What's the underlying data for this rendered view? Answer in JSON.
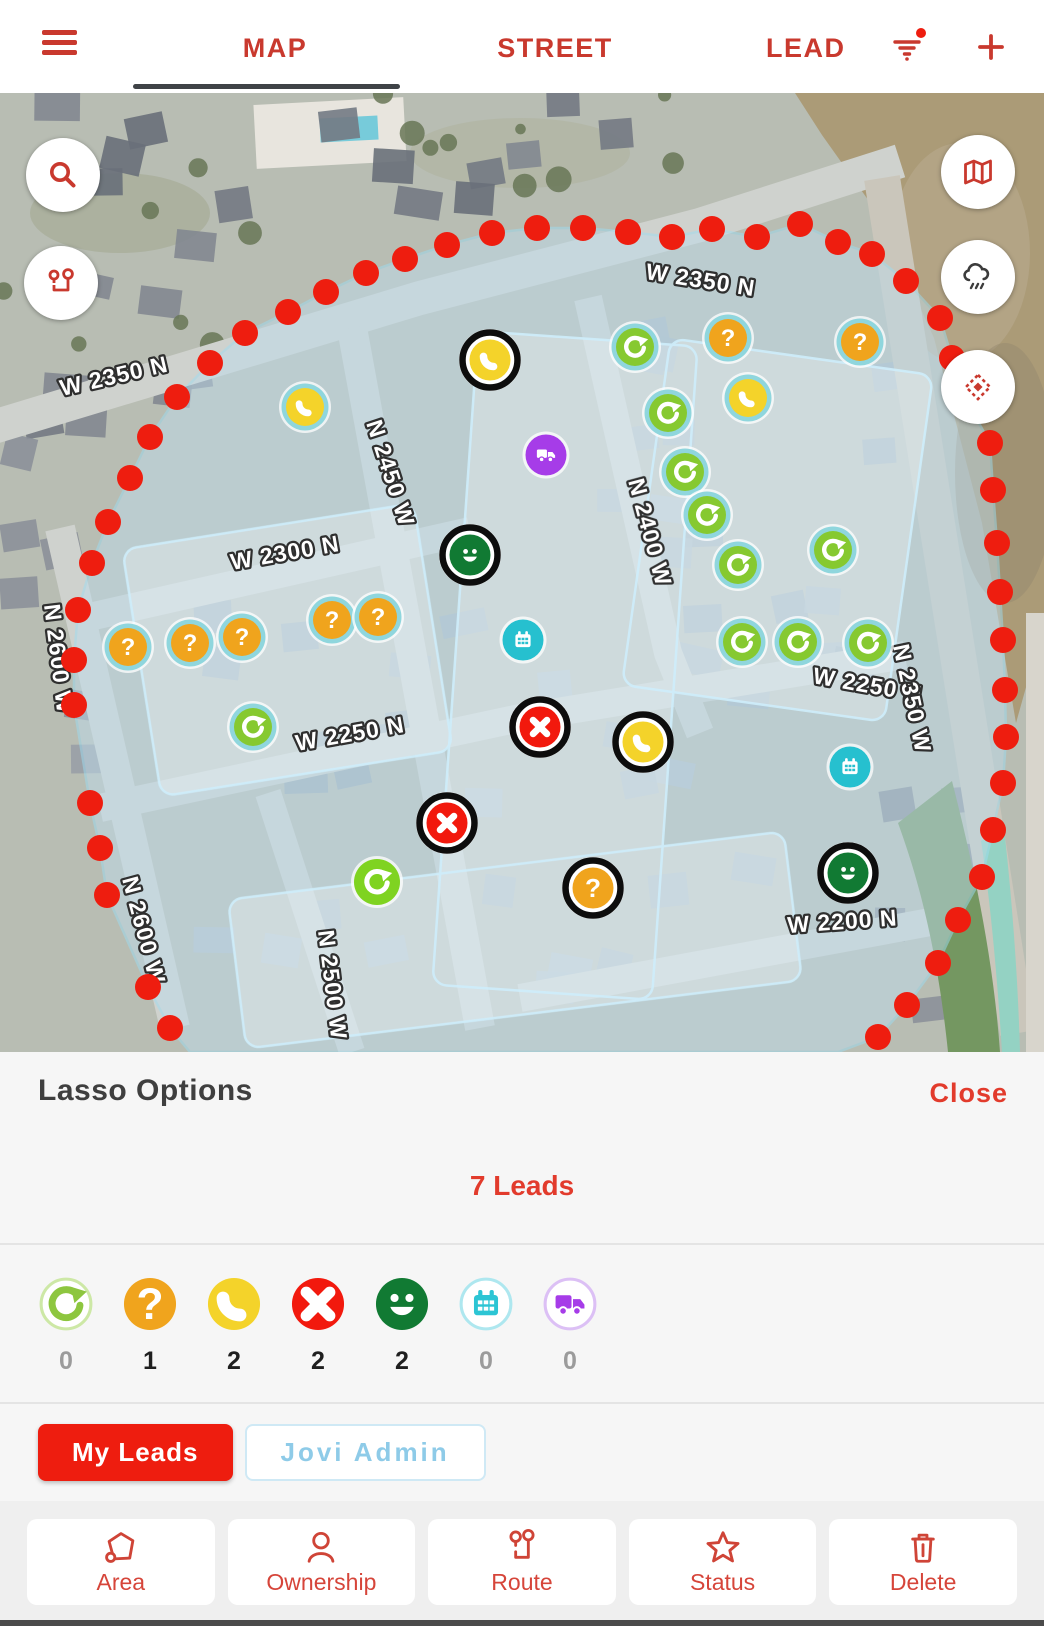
{
  "app": {
    "accent": "#c9392e",
    "bright_red": "#ee1d0f"
  },
  "top_bar": {
    "menu_icon": "hamburger-icon",
    "tabs": [
      {
        "label": "MAP",
        "active": true
      },
      {
        "label": "STREET",
        "active": false
      },
      {
        "label": "LEAD",
        "active": false
      }
    ],
    "filter_icon": "filter-icon",
    "filter_badge_color": "#ee1d0f",
    "add_icon": "plus-icon"
  },
  "map": {
    "controls_left": [
      {
        "icon": "search-icon"
      },
      {
        "icon": "route-pins-icon"
      }
    ],
    "controls_right": [
      {
        "icon": "map-layers-icon"
      },
      {
        "icon": "weather-icon"
      },
      {
        "icon": "lasso-target-icon"
      }
    ],
    "street_labels": [
      {
        "text": "W 2350 N",
        "x": 62,
        "y": 303,
        "rot": -13
      },
      {
        "text": "W 2350 N",
        "x": 645,
        "y": 186,
        "rot": 9
      },
      {
        "text": "N 2450 W",
        "x": 366,
        "y": 330,
        "rot": 72
      },
      {
        "text": "N 2400 W",
        "x": 628,
        "y": 388,
        "rot": 75
      },
      {
        "text": "W 2300 N",
        "x": 232,
        "y": 477,
        "rot": -10
      },
      {
        "text": "N 2600 W",
        "x": 44,
        "y": 512,
        "rot": 83
      },
      {
        "text": "W 2250 N",
        "x": 297,
        "y": 658,
        "rot": -10
      },
      {
        "text": "W 2250 N",
        "x": 812,
        "y": 590,
        "rot": 10
      },
      {
        "text": "N 2350 W",
        "x": 893,
        "y": 553,
        "rot": 78
      },
      {
        "text": "N 2600 W",
        "x": 122,
        "y": 786,
        "rot": 75
      },
      {
        "text": "N 2500 W",
        "x": 318,
        "y": 838,
        "rot": 83
      },
      {
        "text": "W 2200 N",
        "x": 788,
        "y": 840,
        "rot": -4
      }
    ],
    "lasso": {
      "dot_color": "#ee1d0f",
      "fill": "#bfdcec",
      "stroke": "#9edcf2",
      "dots": [
        [
          170,
          935
        ],
        [
          148,
          894
        ],
        [
          107,
          802
        ],
        [
          100,
          755
        ],
        [
          90,
          710
        ],
        [
          74,
          612
        ],
        [
          74,
          567
        ],
        [
          78,
          517
        ],
        [
          92,
          470
        ],
        [
          108,
          429
        ],
        [
          130,
          385
        ],
        [
          150,
          344
        ],
        [
          177,
          304
        ],
        [
          210,
          270
        ],
        [
          245,
          240
        ],
        [
          288,
          219
        ],
        [
          326,
          199
        ],
        [
          366,
          180
        ],
        [
          405,
          166
        ],
        [
          447,
          152
        ],
        [
          492,
          140
        ],
        [
          537,
          135
        ],
        [
          583,
          135
        ],
        [
          628,
          139
        ],
        [
          672,
          144
        ],
        [
          712,
          136
        ],
        [
          757,
          144
        ],
        [
          800,
          131
        ],
        [
          838,
          149
        ],
        [
          872,
          161
        ],
        [
          906,
          188
        ],
        [
          940,
          225
        ],
        [
          952,
          265
        ],
        [
          966,
          307
        ],
        [
          990,
          350
        ],
        [
          993,
          397
        ],
        [
          997,
          450
        ],
        [
          1000,
          499
        ],
        [
          1003,
          547
        ],
        [
          1005,
          597
        ],
        [
          1006,
          644
        ],
        [
          1003,
          690
        ],
        [
          993,
          737
        ],
        [
          982,
          784
        ],
        [
          958,
          827
        ],
        [
          938,
          870
        ],
        [
          907,
          912
        ],
        [
          878,
          944
        ]
      ]
    },
    "marker_colors": {
      "refresh": "#86c930",
      "refresh_bright": "#7fd321",
      "question": "#f0a41d",
      "phone": "#f4d32a",
      "x": "#f2190d",
      "smiley": "#117a33",
      "calendar": "#26c0cf",
      "truck": "#a63ce8"
    },
    "ring_colors": {
      "teal": "#8fd6dd",
      "selected": "#0d0d0d"
    },
    "markers": [
      {
        "type": "phone",
        "ring": "teal",
        "x": 305,
        "y": 314
      },
      {
        "type": "truck",
        "ring": "plain",
        "x": 546,
        "y": 362
      },
      {
        "type": "calendar",
        "ring": "plain",
        "x": 523,
        "y": 547
      },
      {
        "type": "calendar",
        "ring": "plain",
        "x": 850,
        "y": 674
      },
      {
        "type": "refresh",
        "ring": "teal",
        "x": 253,
        "y": 634
      },
      {
        "type": "refresh_bright",
        "ring": "plain",
        "x": 377,
        "y": 789
      },
      {
        "type": "question",
        "ring": "teal",
        "x": 128,
        "y": 554
      },
      {
        "type": "question",
        "ring": "teal",
        "x": 190,
        "y": 550
      },
      {
        "type": "question",
        "ring": "teal",
        "x": 242,
        "y": 544
      },
      {
        "type": "question",
        "ring": "teal",
        "x": 332,
        "y": 527
      },
      {
        "type": "question",
        "ring": "teal",
        "x": 378,
        "y": 524
      },
      {
        "type": "question",
        "ring": "teal",
        "x": 728,
        "y": 245
      },
      {
        "type": "question",
        "ring": "teal",
        "x": 860,
        "y": 249
      },
      {
        "type": "phone",
        "ring": "teal",
        "x": 748,
        "y": 305
      },
      {
        "type": "refresh",
        "ring": "teal",
        "x": 635,
        "y": 254
      },
      {
        "type": "refresh",
        "ring": "teal",
        "x": 668,
        "y": 320
      },
      {
        "type": "refresh",
        "ring": "teal",
        "x": 685,
        "y": 379
      },
      {
        "type": "refresh",
        "ring": "teal",
        "x": 707,
        "y": 422
      },
      {
        "type": "refresh",
        "ring": "teal",
        "x": 738,
        "y": 472
      },
      {
        "type": "refresh",
        "ring": "teal",
        "x": 833,
        "y": 457
      },
      {
        "type": "refresh",
        "ring": "teal",
        "x": 742,
        "y": 549
      },
      {
        "type": "refresh",
        "ring": "teal",
        "x": 798,
        "y": 549
      },
      {
        "type": "refresh",
        "ring": "teal",
        "x": 868,
        "y": 550
      },
      {
        "type": "phone",
        "ring": "selected",
        "x": 490,
        "y": 267
      },
      {
        "type": "smiley",
        "ring": "selected",
        "x": 470,
        "y": 462
      },
      {
        "type": "x",
        "ring": "selected",
        "x": 540,
        "y": 634
      },
      {
        "type": "phone",
        "ring": "selected",
        "x": 643,
        "y": 649
      },
      {
        "type": "x",
        "ring": "selected",
        "x": 447,
        "y": 730
      },
      {
        "type": "question",
        "ring": "selected",
        "x": 593,
        "y": 795
      },
      {
        "type": "smiley",
        "ring": "selected",
        "x": 848,
        "y": 780
      }
    ]
  },
  "lasso_panel": {
    "title": "Lasso Options",
    "close_label": "Close",
    "leads_summary": "7 Leads",
    "statuses": [
      {
        "type": "refresh",
        "count": 0,
        "color": "#8dc63f",
        "style": "outline",
        "border": "#cde8a6"
      },
      {
        "type": "question",
        "count": 1,
        "color": "#f0a41d",
        "style": "filled"
      },
      {
        "type": "phone",
        "count": 2,
        "color": "#f4d32a",
        "style": "filled"
      },
      {
        "type": "x",
        "count": 2,
        "color": "#f2190d",
        "style": "filled"
      },
      {
        "type": "smiley",
        "count": 2,
        "color": "#117a33",
        "style": "filled"
      },
      {
        "type": "calendar",
        "count": 0,
        "color": "#2cc5d4",
        "style": "outline",
        "border": "#aee7ef"
      },
      {
        "type": "truck",
        "count": 0,
        "color": "#a63ce8",
        "style": "outline",
        "border": "#dcc0f5"
      }
    ],
    "owner_filters": [
      {
        "label": "My Leads",
        "active": true
      },
      {
        "label": "Jovi Admin",
        "active": false
      }
    ],
    "actions": [
      {
        "label": "Area",
        "icon": "area-icon"
      },
      {
        "label": "Ownership",
        "icon": "ownership-icon"
      },
      {
        "label": "Route",
        "icon": "route-icon"
      },
      {
        "label": "Status",
        "icon": "status-icon"
      },
      {
        "label": "Delete",
        "icon": "delete-icon"
      }
    ]
  }
}
